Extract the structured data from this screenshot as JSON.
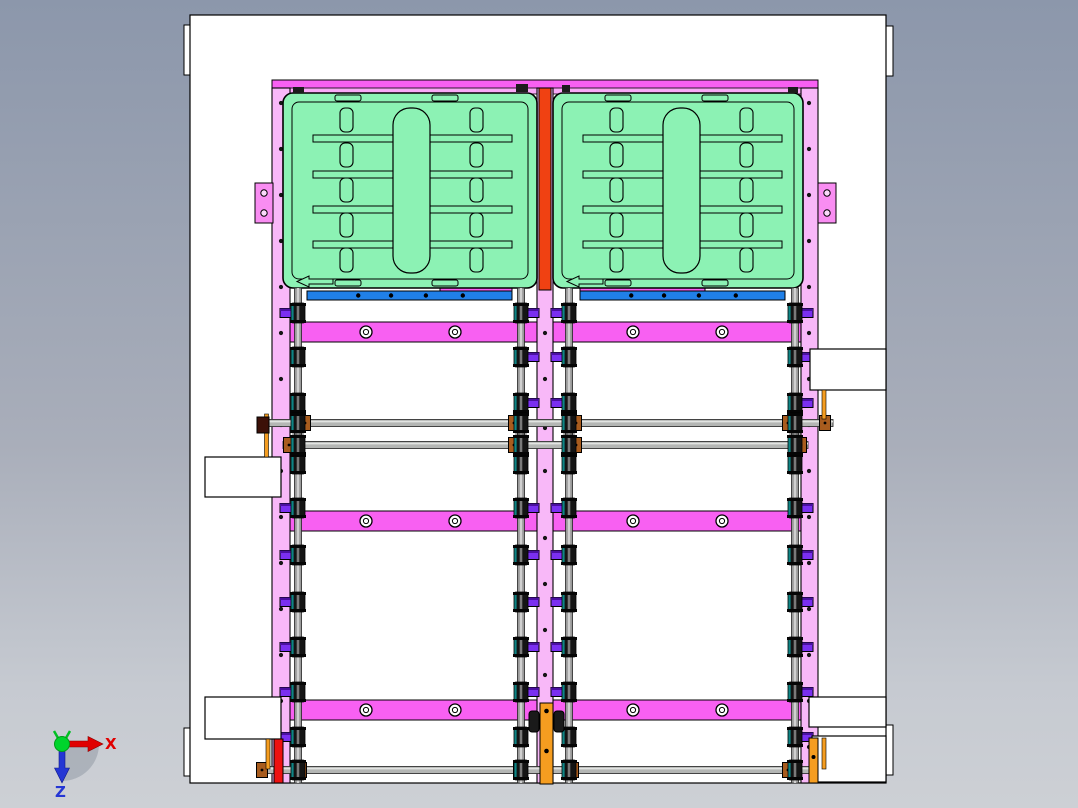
{
  "viewport": {
    "kind": "cad-front-view",
    "width": 1078,
    "height": 808
  },
  "axis": {
    "x_label": "X",
    "z_label": "Z",
    "x_color": "#e00000",
    "z_color": "#2436d4",
    "y_color": "#00d42c"
  },
  "palette": {
    "background_top": "#8c97ab",
    "background_bottom": "#cdd0d5",
    "sheet": "#ffffff",
    "outline": "#000000",
    "magenta": "#f860f2",
    "pink_light": "#f8b8f8",
    "pink_strip": "#f9a9f7",
    "pink_bracket": "#f98df2",
    "bracket_hole": "#fbd8fb",
    "green": "#8cf2b4",
    "blue": "#2080e8",
    "red_orange": "#f04112",
    "red": "#ee1111",
    "orange": "#f59d20",
    "purple": "#7a2ff0",
    "purple_dark": "#4a10a0",
    "gray_rail": "#9a9a9a",
    "gray_rail_hi": "#d0d0d0",
    "shaft": "#b4b6b4",
    "shaft_hi": "#e2e4e2",
    "brown": "#a85c1e",
    "roller": "#141414",
    "teal": "#0e8585",
    "coupler": "#1a1a1a"
  },
  "machine": {
    "sheet": {
      "x": 190,
      "y": 15,
      "w": 696,
      "h": 768
    },
    "tabs": [
      [
        184,
        25,
        7,
        50
      ],
      [
        886,
        26,
        7,
        50
      ],
      [
        184,
        728,
        7,
        48
      ],
      [
        886,
        725,
        7,
        50
      ]
    ],
    "top_beam": [
      272,
      80,
      546,
      9
    ],
    "top_strip": [
      278,
      88,
      534,
      6
    ],
    "pink_rails": [
      [
        272,
        88,
        18,
        695
      ],
      [
        537,
        88,
        16,
        695
      ],
      [
        801,
        88,
        17,
        695
      ]
    ],
    "rail_dot_xs": [
      281,
      809
    ],
    "rail_dot_ys": [
      103,
      149,
      195,
      241,
      287,
      333,
      379,
      425,
      471,
      517,
      563,
      609,
      655,
      701,
      747
    ],
    "center_dot_x": 545,
    "center_dot_ys": [
      333,
      379,
      428,
      471,
      538,
      584,
      630,
      675
    ],
    "red_top_bar": [
      539,
      88,
      12,
      202
    ],
    "trays": [
      {
        "x": 283,
        "w": 254
      },
      {
        "x": 553,
        "w": 250
      }
    ],
    "tray": {
      "y": 93,
      "h": 195,
      "rx": 10,
      "inset": 9,
      "center_slot": [
        110,
        108,
        37,
        165,
        17
      ],
      "slot_cols": [
        57,
        187
      ],
      "slot_w": 13,
      "slot_h": 24,
      "slot_ys": [
        108,
        143,
        178,
        213,
        248
      ],
      "bars": [
        30,
        199,
        7
      ],
      "bar_ys": [
        135,
        171,
        206,
        241
      ],
      "notches": [
        52,
        149
      ],
      "notch_w": 26,
      "notch_h": 6
    },
    "clamp_marks": [
      [
        293,
        87,
        11,
        6
      ],
      [
        516,
        84,
        12,
        8
      ],
      [
        562,
        85,
        8,
        7
      ],
      [
        788,
        87,
        10,
        6
      ]
    ],
    "blue_bars": [
      [
        307,
        291,
        205,
        9
      ],
      [
        580,
        291,
        205,
        9
      ]
    ],
    "blue_screw_fracs": [
      0.25,
      0.41,
      0.58,
      0.76
    ],
    "magenta_strips": [
      [
        440,
        285,
        72,
        7
      ],
      [
        580,
        285,
        125,
        7
      ]
    ],
    "beams": {
      "x": 282,
      "w": 527,
      "h": 20,
      "ys": [
        322,
        511,
        700
      ],
      "hole_xs": [
        366,
        455,
        633,
        722
      ]
    },
    "gray_rails_x": [
      298,
      521,
      569,
      795
    ],
    "gray_rails_y": [
      288,
      783
    ],
    "stub_dirs": [
      -1,
      1,
      -1,
      1
    ],
    "rows": [
      {
        "y": 313,
        "stubs": [
          0,
          1,
          2,
          3
        ]
      },
      {
        "y": 357,
        "stubs": [
          1,
          2,
          3
        ]
      },
      {
        "y": 403,
        "stubs": [
          1,
          2,
          3
        ]
      },
      {
        "y": 464,
        "stubs": []
      },
      {
        "y": 508,
        "stubs": [
          0,
          1,
          2,
          3
        ]
      },
      {
        "y": 555,
        "stubs": [
          0,
          1,
          2,
          3
        ]
      },
      {
        "y": 602,
        "stubs": [
          0,
          1,
          2,
          3
        ]
      },
      {
        "y": 647,
        "stubs": [
          0,
          1,
          2,
          3
        ]
      },
      {
        "y": 692,
        "stubs": [
          0,
          1,
          2,
          3
        ]
      },
      {
        "y": 737,
        "stubs": [
          0,
          3
        ]
      }
    ],
    "shafts": [
      {
        "y": 423,
        "x1": 257,
        "x2": 833,
        "collars": [
          305,
          514,
          576,
          788,
          825
        ]
      },
      {
        "y": 445,
        "x1": 283,
        "x2": 808,
        "collars": [
          289,
          514,
          576,
          801
        ]
      },
      {
        "y": 770,
        "x1": 257,
        "x2": 830,
        "collars": [
          262,
          301,
          519,
          573,
          788,
          824
        ]
      }
    ],
    "white_boxes": [
      [
        205,
        457,
        76,
        40
      ],
      [
        205,
        697,
        76,
        42
      ],
      [
        810,
        349,
        76,
        41
      ],
      [
        809,
        697,
        77,
        30
      ],
      [
        812,
        736,
        74,
        46
      ]
    ],
    "brackets": [
      [
        255,
        183
      ],
      [
        818,
        183
      ]
    ],
    "posts": {
      "center": [
        540,
        703,
        13,
        81
      ],
      "center_couplers": [
        [
          529,
          711,
          10,
          21
        ],
        [
          554,
          711,
          10,
          21
        ]
      ],
      "center_screw_ys": [
        711,
        751
      ],
      "left_red": [
        274,
        739,
        9,
        44
      ],
      "left_pin": [
        266,
        739,
        4,
        30
      ],
      "right_orange": [
        809,
        738,
        9,
        45
      ],
      "right_pin": [
        822,
        738,
        4,
        31
      ],
      "upper_left_pin": [
        264.5,
        414,
        4,
        43
      ],
      "upper_left_collar": [
        257,
        417,
        12,
        16
      ],
      "upper_right_pin": [
        822,
        390,
        4,
        29
      ]
    }
  }
}
